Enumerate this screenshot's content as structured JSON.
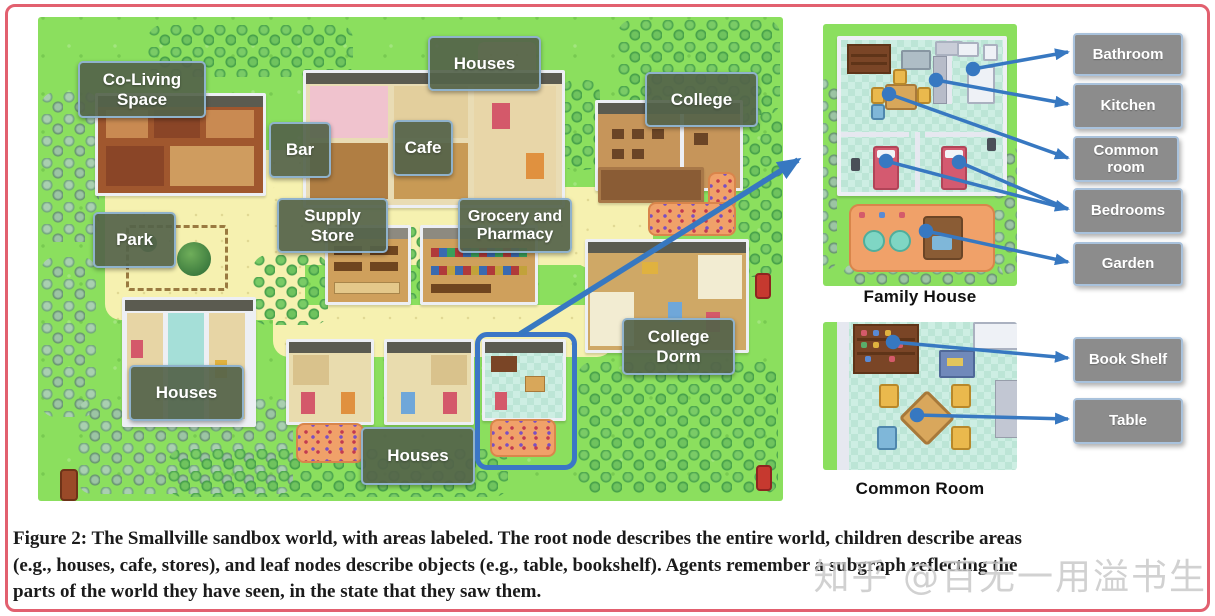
{
  "map": {
    "area_labels": [
      {
        "id": "co-living-space",
        "text": "Co-Living Space"
      },
      {
        "id": "houses-top",
        "text": "Houses"
      },
      {
        "id": "college",
        "text": "College"
      },
      {
        "id": "bar",
        "text": "Bar"
      },
      {
        "id": "cafe",
        "text": "Cafe"
      },
      {
        "id": "supply-store",
        "text": "Supply Store"
      },
      {
        "id": "grocery-pharmacy",
        "text": "Grocery and Pharmacy"
      },
      {
        "id": "park",
        "text": "Park"
      },
      {
        "id": "college-dorm",
        "text": "College Dorm"
      },
      {
        "id": "houses-bottom-left",
        "text": "Houses"
      },
      {
        "id": "houses-bottom-middle",
        "text": "Houses"
      }
    ]
  },
  "insets": {
    "family_house": {
      "caption": "Family House",
      "labels": [
        {
          "text": "Bathroom"
        },
        {
          "text": "Kitchen"
        },
        {
          "text": "Common room"
        },
        {
          "text": "Bedrooms"
        },
        {
          "text": "Garden"
        }
      ]
    },
    "common_room": {
      "caption": "Common Room",
      "labels": [
        {
          "text": "Book Shelf"
        },
        {
          "text": "Table"
        }
      ]
    }
  },
  "figure": {
    "caption_lines": [
      "Figure 2: The Smallville sandbox world, with areas labeled. The root node describes the entire world, children describe areas",
      "(e.g., houses, cafe, stores), and leaf nodes describe objects (e.g., table, bookshelf). Agents remember a subgraph reflecting the",
      "parts of the world they have seen, in the state that they saw them."
    ]
  },
  "watermark": {
    "text": "知乎 @百无一用溢书生"
  },
  "colors": {
    "frame_border": "#e2606f",
    "map_green": "#8bdf5e",
    "path_yellow": "#f6f1b0",
    "area_label_bg": "#54634a",
    "area_label_border": "#8fb2cc",
    "gray_label_bg": "#8c8c8c",
    "gray_label_border": "#a9c2dc",
    "arrow_blue": "#3778c1",
    "highlight_blue": "#3b76c6"
  }
}
